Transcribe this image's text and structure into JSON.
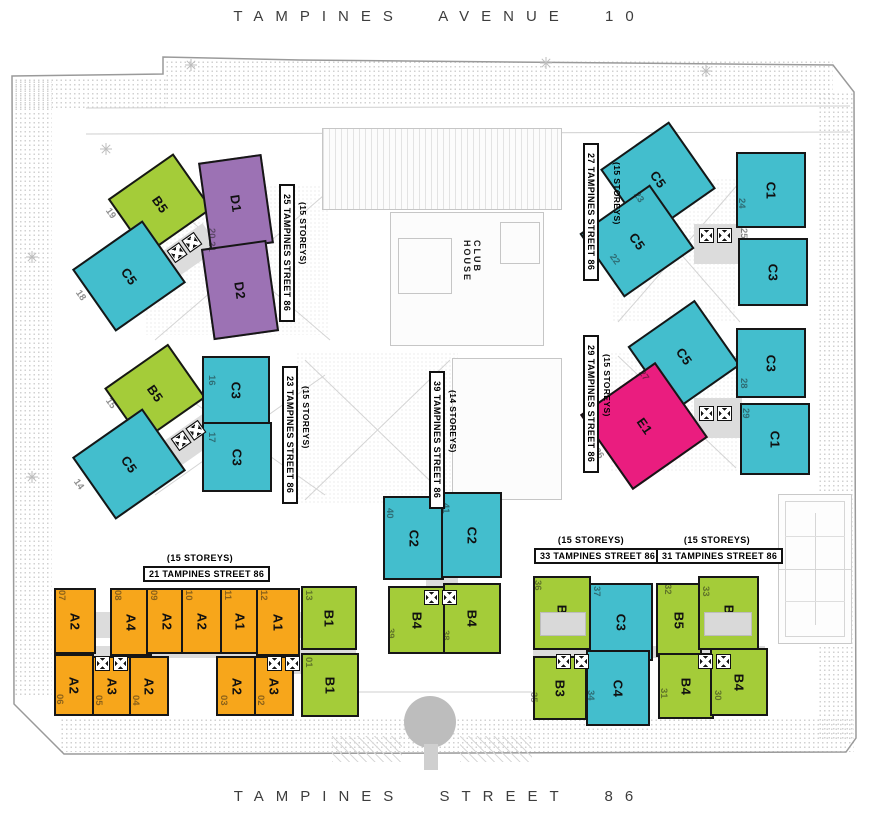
{
  "streets": {
    "top": "TAMPINES AVENUE 10",
    "bottom": "TAMPINES STREET 86"
  },
  "club_house": "CLUB HOUSE",
  "palette": {
    "a": "#F7A61B",
    "b": "#A4CC39",
    "c": "#43BECD",
    "d": "#9C72B4",
    "e": "#EA1D7F"
  },
  "buildings": [
    {
      "label": "B5",
      "type": "B"
    },
    {
      "label": "C5",
      "type": "C"
    },
    {
      "label": "D1",
      "type": "D"
    },
    {
      "label": "D2",
      "type": "D"
    },
    {
      "label": "B5",
      "type": "B"
    },
    {
      "label": "C5",
      "type": "C"
    },
    {
      "label": "C3",
      "type": "C"
    },
    {
      "label": "C3",
      "type": "C"
    },
    {
      "label": "C5",
      "type": "C"
    },
    {
      "label": "C5",
      "type": "C"
    },
    {
      "label": "C1",
      "type": "C"
    },
    {
      "label": "C3",
      "type": "C"
    },
    {
      "label": "C5",
      "type": "C"
    },
    {
      "label": "E1",
      "type": "E"
    },
    {
      "label": "C3",
      "type": "C"
    },
    {
      "label": "C1",
      "type": "C"
    },
    {
      "label": "C2",
      "type": "C"
    },
    {
      "label": "C2",
      "type": "C"
    },
    {
      "label": "B4",
      "type": "B"
    },
    {
      "label": "B4",
      "type": "B"
    },
    {
      "label": "B1",
      "type": "B"
    },
    {
      "label": "B1",
      "type": "B"
    },
    {
      "label": "A2",
      "type": "A"
    },
    {
      "label": "A4",
      "type": "A"
    },
    {
      "label": "A2",
      "type": "A"
    },
    {
      "label": "A2",
      "type": "A"
    },
    {
      "label": "A1",
      "type": "A"
    },
    {
      "label": "A1",
      "type": "A"
    },
    {
      "label": "A2",
      "type": "A"
    },
    {
      "label": "A3",
      "type": "A"
    },
    {
      "label": "A2",
      "type": "A"
    },
    {
      "label": "A2",
      "type": "A"
    },
    {
      "label": "A3",
      "type": "A"
    },
    {
      "label": "B2",
      "type": "B"
    },
    {
      "label": "C3",
      "type": "C"
    },
    {
      "label": "B5",
      "type": "B"
    },
    {
      "label": "B2",
      "type": "B"
    },
    {
      "label": "B3",
      "type": "B"
    },
    {
      "label": "C4",
      "type": "C"
    },
    {
      "label": "B4",
      "type": "B"
    },
    {
      "label": "B4",
      "type": "B"
    }
  ],
  "unit_numbers": [
    "19",
    "18",
    "20 21",
    "15",
    "14",
    "16",
    "17",
    "23",
    "22",
    "24",
    "25",
    "27",
    "26",
    "28",
    "29",
    "40",
    "41",
    "39",
    "38",
    "13",
    "01",
    "07",
    "08",
    "09",
    "10",
    "11",
    "12",
    "06",
    "05",
    "04",
    "03",
    "02",
    "36",
    "37",
    "32",
    "33",
    "35",
    "34",
    "31",
    "30"
  ],
  "address_labels": [
    {
      "storeys": "(15 STOREYS)",
      "address": "25 TAMPINES STREET 86"
    },
    {
      "storeys": "(15 STOREYS)",
      "address": "23 TAMPINES STREET 86"
    },
    {
      "storeys": "(15 STOREYS)",
      "address": "27 TAMPINES STREET 86"
    },
    {
      "storeys": "(15 STOREYS)",
      "address": "29 TAMPINES STREET 86"
    },
    {
      "storeys": "(14 STOREYS)",
      "address": "39 TAMPINES STREET 86"
    },
    {
      "storeys": "(15 STOREYS)",
      "address": "21 TAMPINES STREET 86"
    },
    {
      "storeys": "(15 STOREYS)",
      "address": "33 TAMPINES STREET 86"
    },
    {
      "storeys": "(15 STOREYS)",
      "address": "31 TAMPINES STREET 86"
    }
  ]
}
